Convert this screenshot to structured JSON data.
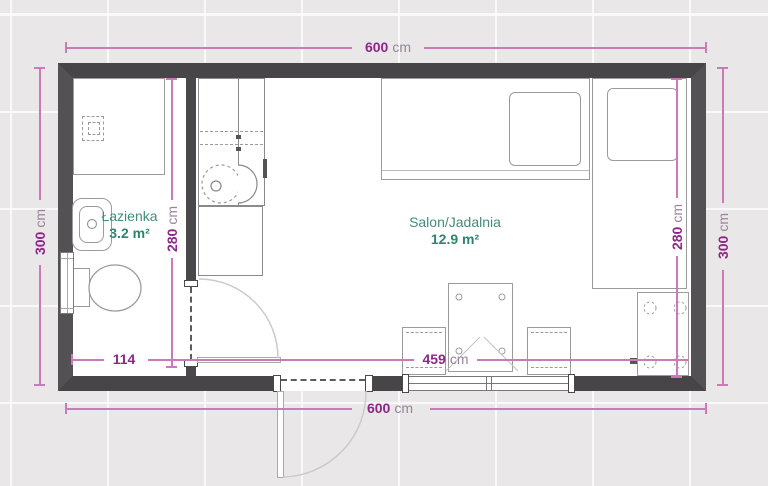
{
  "plan": {
    "rooms": {
      "bathroom": {
        "name": "Łazienka",
        "area": "3.2 m²"
      },
      "living": {
        "name": "Salon/Jadalnia",
        "area": "12.9 m²"
      }
    },
    "dims": {
      "top": {
        "value": "600",
        "unit": "cm"
      },
      "bottom": {
        "value": "600",
        "unit": "cm"
      },
      "left": {
        "value": "300",
        "unit": "cm"
      },
      "right": {
        "value": "300",
        "unit": "cm"
      },
      "bath_v": {
        "value": "280",
        "unit": "cm"
      },
      "salon_v": {
        "value": "280",
        "unit": "cm"
      },
      "bath_w": {
        "value": "114",
        "unit": ""
      },
      "salon_w": {
        "value": "459",
        "unit": "cm"
      }
    },
    "colors": {
      "wall": "#4a484a",
      "floor": "#ffffff",
      "background": "#e9e7e8",
      "dimension_line": "#cb7ab7",
      "dimension_value": "#8e2886",
      "dimension_unit": "#998399",
      "room_label": "#3f8d7b",
      "room_area": "#2e8472"
    },
    "furniture": [
      "shower",
      "washbasin",
      "toilet",
      "radiator",
      "kitchen-unit",
      "cabinet",
      "single-bed-horizontal",
      "single-bed-vertical",
      "dining-table",
      "chair-left",
      "chair-right",
      "storage-cabinet",
      "window",
      "interior-door",
      "exterior-door"
    ]
  }
}
